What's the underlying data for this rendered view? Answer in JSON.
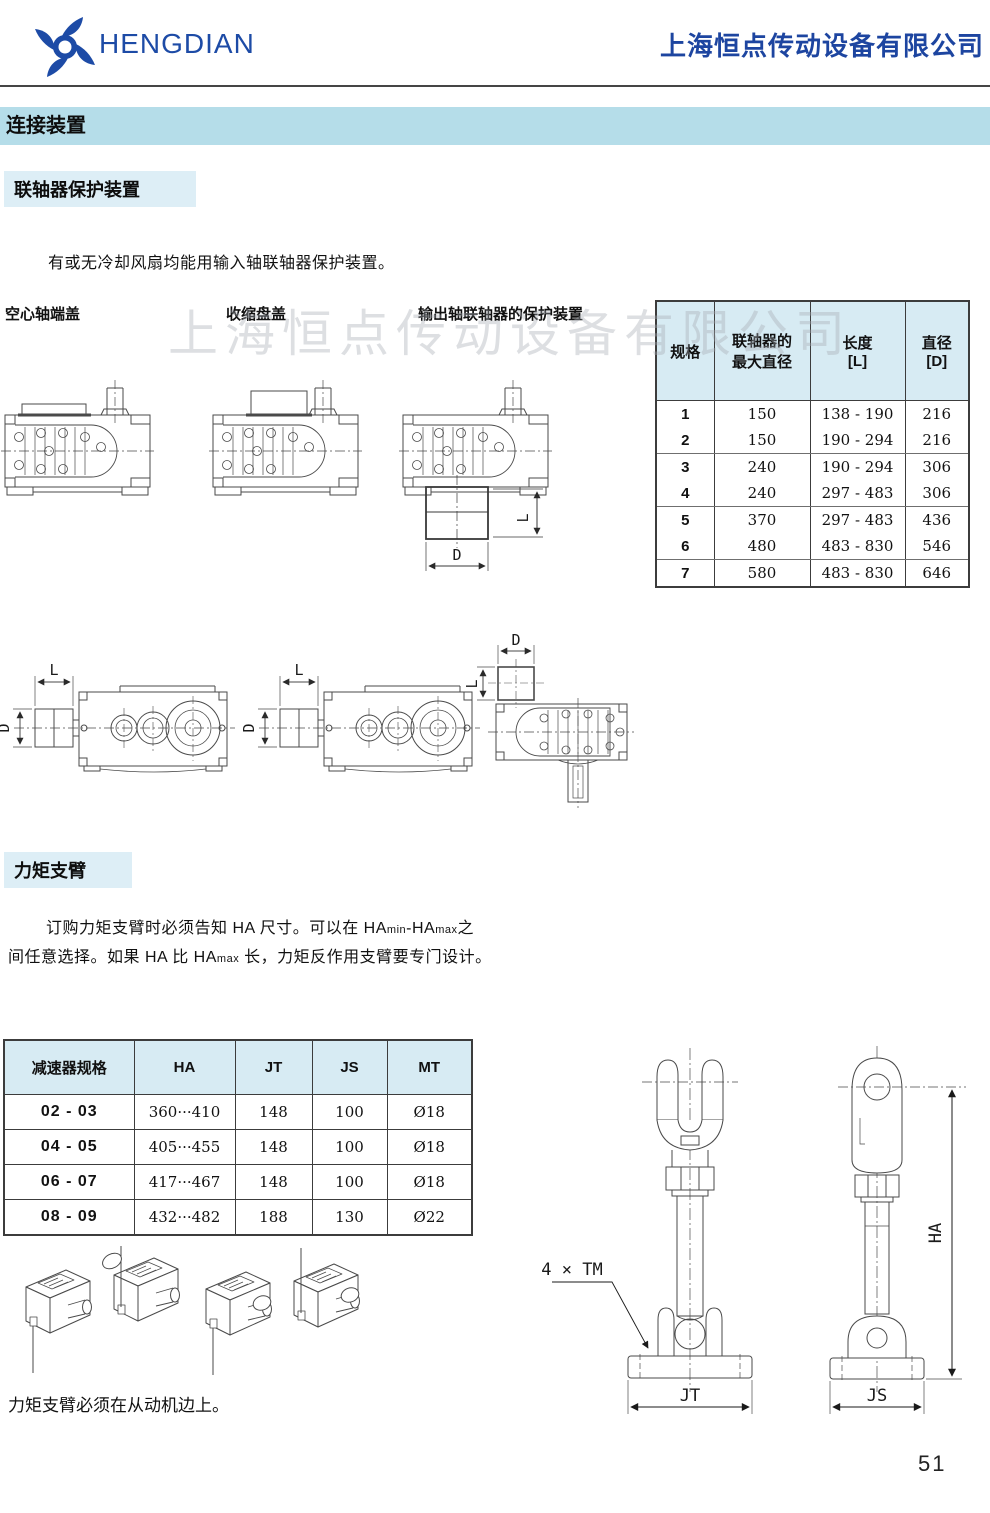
{
  "header": {
    "logo": "HENGDIAN",
    "company": "上海恒点传动设备有限公司"
  },
  "banner": {
    "title": "连接装置"
  },
  "watermark": "上海恒点传动设备有限公司",
  "coupling": {
    "title": "联轴器保护装置",
    "intro": "有或无冷却风扇均能用输入轴联轴器保护装置。",
    "labels": {
      "hollow": "空心轴端盖",
      "shrink": "收缩盘盖",
      "output": "输出轴联轴器的保护装置"
    },
    "table": {
      "headers": [
        "规格",
        "联轴器的\n最大直径",
        "长度\n[L]",
        "直径\n[D]"
      ],
      "rows": [
        [
          "1",
          "150",
          "138 - 190",
          "216"
        ],
        [
          "2",
          "150",
          "190 - 294",
          "216"
        ],
        [
          "3",
          "240",
          "190 - 294",
          "306"
        ],
        [
          "4",
          "240",
          "297 - 483",
          "306"
        ],
        [
          "5",
          "370",
          "297 - 483",
          "436"
        ],
        [
          "6",
          "480",
          "483 - 830",
          "546"
        ],
        [
          "7",
          "580",
          "483 - 830",
          "646"
        ]
      ]
    }
  },
  "torque": {
    "title": "力矩支臂",
    "para": {
      "p1": "订购力矩支臂时必须告知 HA 尺寸。可以在 HA",
      "p1s": "min",
      "p2": "-HA",
      "p2s": "max",
      "p3": "之",
      "p4": "间任意选择。如果 HA 比 HA",
      "p4s": "max",
      "p5": "  长，力矩反作用支臂要专门设计。"
    },
    "table": {
      "headers": [
        "减速器规格",
        "HA",
        "JT",
        "JS",
        "MT"
      ],
      "rows": [
        [
          "02 - 03",
          "360···410",
          "148",
          "100",
          "Ø18"
        ],
        [
          "04 - 05",
          "405···455",
          "148",
          "100",
          "Ø18"
        ],
        [
          "06 - 07",
          "417···467",
          "148",
          "100",
          "Ø18"
        ],
        [
          "08 - 09",
          "432···482",
          "188",
          "130",
          "Ø22"
        ]
      ]
    },
    "note": "力矩支臂必须在从动机边上。",
    "dims": {
      "tm": "4 × TM",
      "jt": "JT",
      "js": "JS",
      "ha": "HA"
    }
  },
  "dims": {
    "l": "L",
    "d": "D"
  },
  "page_number": "51",
  "colors": {
    "brand_blue": "#1d4ba6",
    "banner_bg": "#b5dde9",
    "label_bg": "#ddeef6",
    "table_header_bg": "#d7ebf3"
  }
}
